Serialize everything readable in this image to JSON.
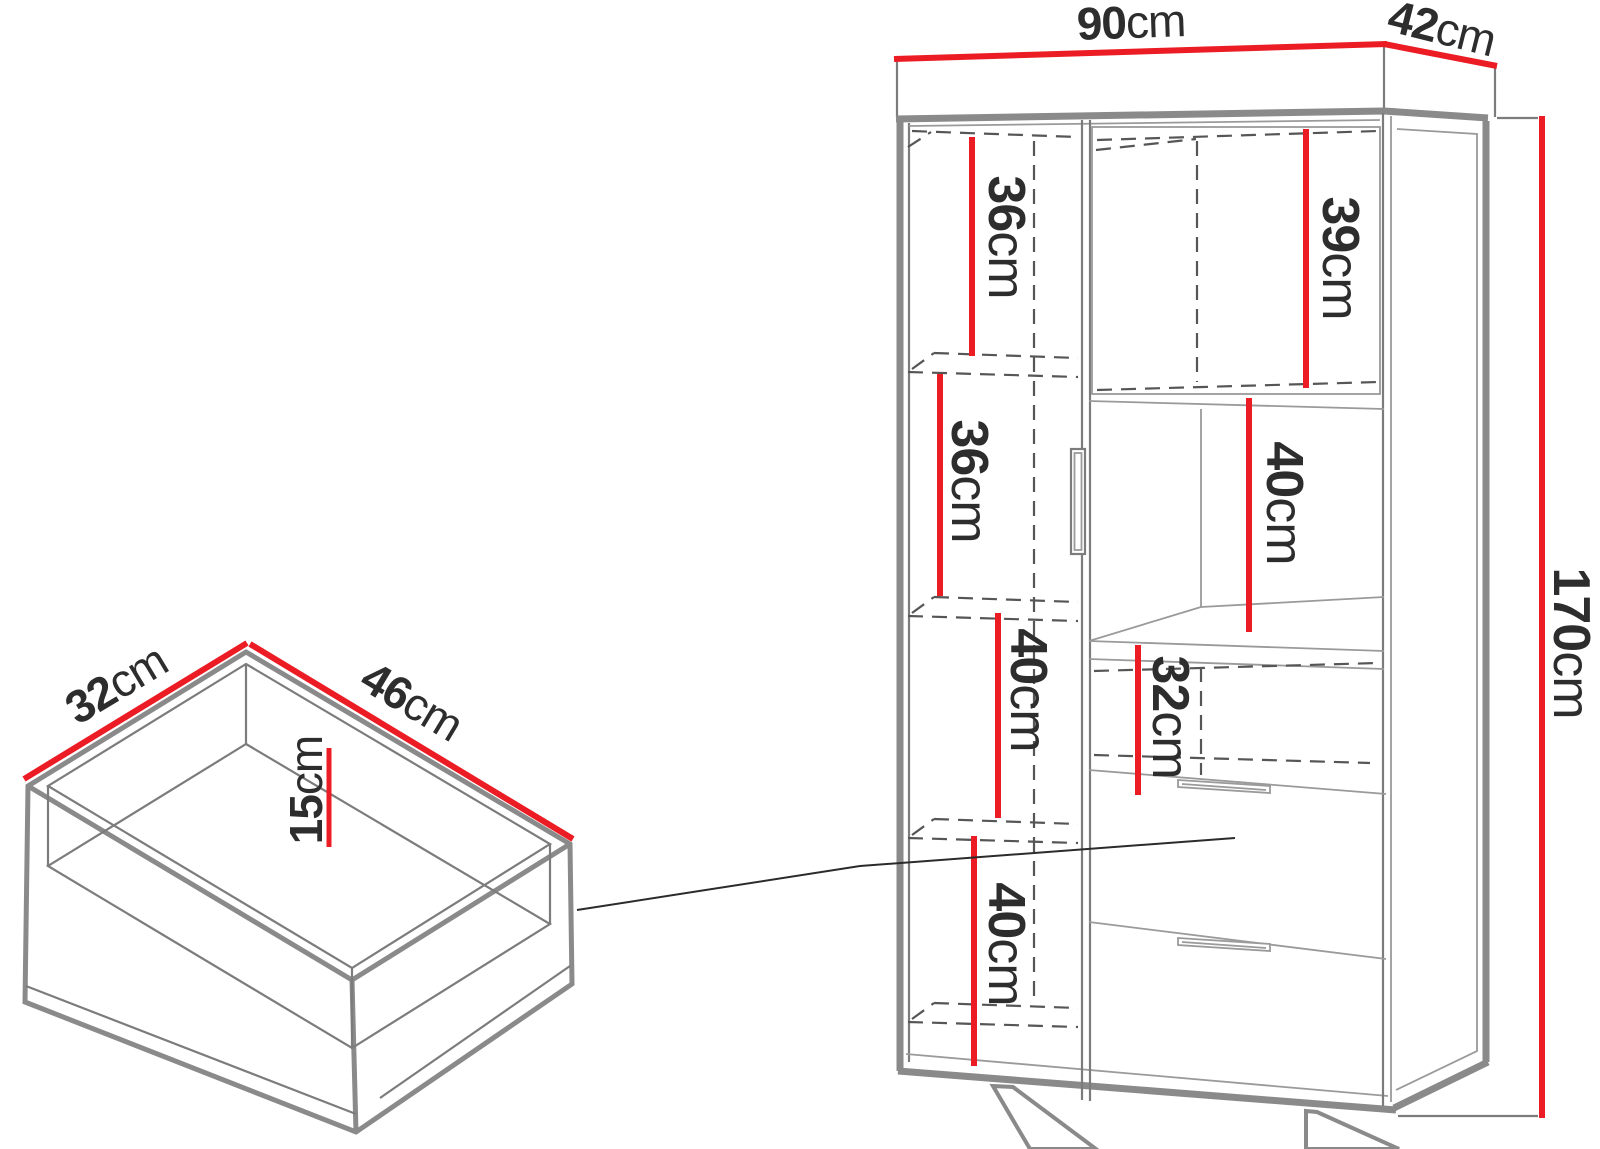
{
  "colors": {
    "dimension_accent": "#ec1c24",
    "outline_gray": "#8a8a8a",
    "dashed_line": "#565656",
    "text": "#2d2d2d",
    "background": "#ffffff"
  },
  "cabinet": {
    "width": {
      "value": "90",
      "unit": "cm"
    },
    "depth": {
      "value": "42",
      "unit": "cm"
    },
    "height": {
      "value": "170",
      "unit": "cm"
    },
    "left_column_shelves": [
      {
        "value": "36",
        "unit": "cm"
      },
      {
        "value": "36",
        "unit": "cm"
      },
      {
        "value": "40",
        "unit": "cm"
      },
      {
        "value": "40",
        "unit": "cm"
      }
    ],
    "right_column_shelves": [
      {
        "value": "39",
        "unit": "cm"
      },
      {
        "value": "40",
        "unit": "cm"
      },
      {
        "value": "32",
        "unit": "cm"
      }
    ]
  },
  "drawer": {
    "depth": {
      "value": "32",
      "unit": "cm"
    },
    "width": {
      "value": "46",
      "unit": "cm"
    },
    "height": {
      "value": "15",
      "unit": "cm"
    }
  }
}
